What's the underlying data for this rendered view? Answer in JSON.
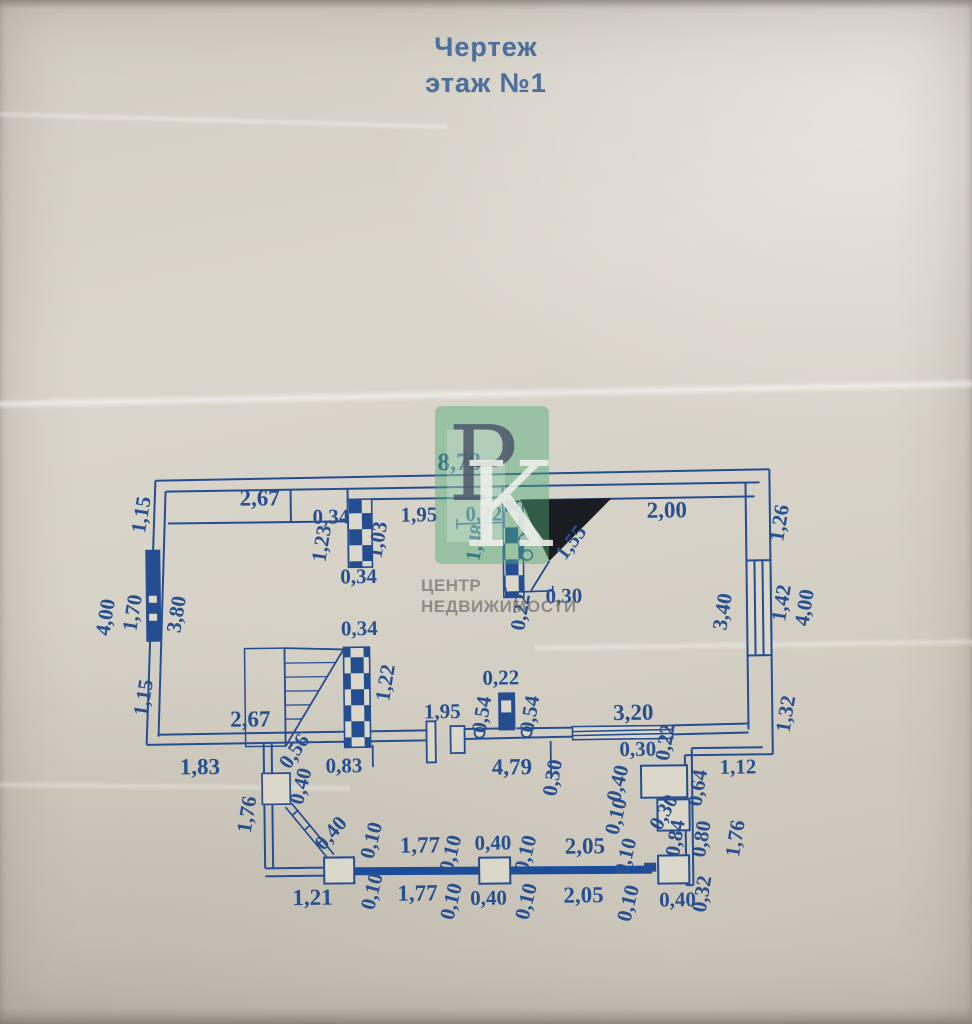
{
  "title": {
    "line1": "Чертеж",
    "line2": "этаж №1"
  },
  "watermark": {
    "letter1": "Р",
    "letter2": "К",
    "caption_line1": "ЦЕНТР",
    "caption_line2": "НЕДВИЖИМОСТИ"
  },
  "colors": {
    "ink": "#254e91",
    "label": "#27508f",
    "title_blue": "#4d6f9c",
    "paper": "#d7d2c7",
    "stair_arrow_black": "#1b1c21",
    "watermark_green": "rgba(80,170,120,0.45)"
  },
  "dims": {
    "d01": "8,78",
    "d02": "2,67",
    "d03": "0,34",
    "d04": "1,95",
    "d05": "0,22",
    "d06": "2,00",
    "d07": "0,34",
    "d08": "0,30",
    "d09": "0,34",
    "d10": "0,22",
    "d11": "2,67",
    "d12": "1,95",
    "d13": "3,20",
    "d14": "1,83",
    "d15": "0,83",
    "d16": "4,79",
    "d17": "0,30",
    "d18": "1,12",
    "d19": "1,77",
    "d20": "0,40",
    "d21": "2,05",
    "d22": "1,21",
    "d23": "1,77",
    "d24": "0,40",
    "d25": "2,05",
    "d26": "0,40",
    "d27": "1,15",
    "d28": "1,23",
    "d29": "1,03",
    "d30": "1,48",
    "d31": "1,26",
    "d32": "4,00",
    "d33": "1,70",
    "d34": "3,80",
    "d35": "0,22",
    "d36": "3,40",
    "d37": "1,42",
    "d38": "4,00",
    "d39": "1,15",
    "d40": "1,22",
    "d41": "0,54",
    "d42": "0,54",
    "d43": "1,32",
    "d44": "0,30",
    "d45": "0,22",
    "d46": "0,40",
    "d47": "1,76",
    "d48": "0,64",
    "d49": "0,40",
    "d50": "0,10",
    "d51": "0,84",
    "d52": "0,80",
    "d53": "1,76",
    "d54": "0,10",
    "d55": "0,10",
    "d56": "0,10",
    "d57": "0,10",
    "d58": "0,10",
    "d59": "0,10",
    "d60": "0,10",
    "d61": "0,10",
    "d62": "0,32",
    "d63": "1,55",
    "d64": "0,56",
    "d65": "0,40",
    "d66": "0,30"
  }
}
